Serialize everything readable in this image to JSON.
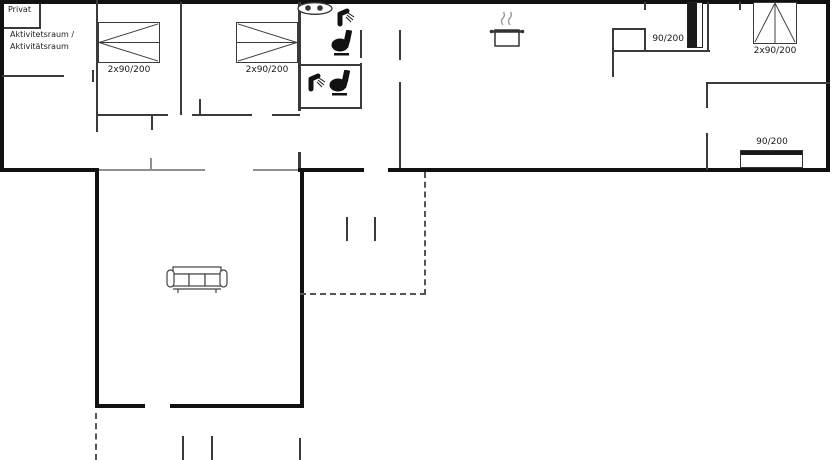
{
  "canvas": {
    "width": 834,
    "height": 460,
    "background": "#ffffff"
  },
  "colors": {
    "outer_wall": "#111111",
    "interior_wall": "#3a3a3a",
    "open_boundary": "#8f8f8f",
    "dashed_line": "#555555",
    "icon": "#111111",
    "text": "#1a1a1a"
  },
  "labels": {
    "privat": "Privat",
    "activity_room": {
      "line1": "Aktivitetsraum /",
      "line2": "Aktivitätsraum"
    },
    "beds": {
      "bedroom1": "2x90/200",
      "bedroom2": "2x90/200",
      "small_bedroom": "90/200",
      "top_right_bedroom": "2x90/200",
      "bottom_right_bedroom": "90/200"
    }
  },
  "icons": {
    "bathroom_main": [
      "washbasin-icon",
      "shower-icon",
      "toilet-icon"
    ],
    "bathroom_second": [
      "shower-icon",
      "toilet-icon"
    ],
    "kitchen": [
      "cooking-pot-icon"
    ],
    "living_room": [
      "sofa-icon"
    ]
  },
  "features": {
    "terrace_outline": "dashed",
    "door_openings": "gaps in walls"
  }
}
